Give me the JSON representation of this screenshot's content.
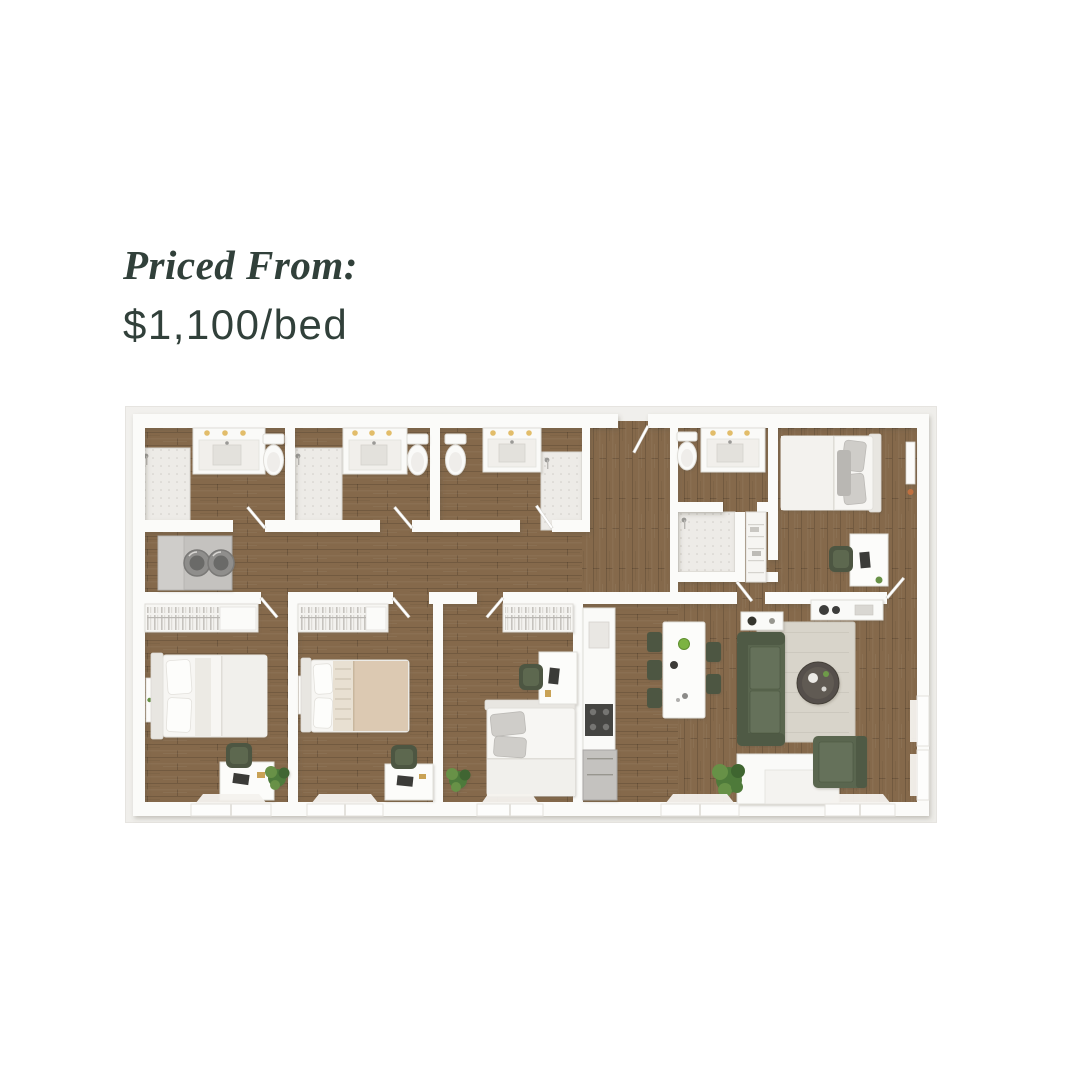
{
  "page": {
    "background": "#ffffff"
  },
  "pricing": {
    "label": "Priced From:",
    "value": "$1,100/bed"
  },
  "floor_plan": {
    "type": "3d-floorplan-rendering",
    "rooms": [
      "bathroom-1",
      "bathroom-2",
      "bathroom-3",
      "bathroom-4",
      "bedroom-1",
      "bedroom-2",
      "bedroom-3",
      "bedroom-4",
      "laundry-closet",
      "entry-hall",
      "hallway",
      "kitchen",
      "dining-area",
      "living-room"
    ],
    "colors": {
      "text": "#31403a",
      "plan_mat": "#f0efeb",
      "wall": "#fbfbf9",
      "wood_floor": "#85694b",
      "tile": "#edebe7",
      "sofa_green": "#5a6650",
      "chair_green": "#4d5742",
      "rug": "#d8d4ca",
      "plant_green": "#4e7a3a",
      "vanity_light": "#e2bd6a",
      "appliance_gray": "#c4c2bf",
      "coffee_table": "#55504b",
      "bed_white": "#f7f6f3",
      "tan_blanket": "#dcc9b2"
    }
  }
}
